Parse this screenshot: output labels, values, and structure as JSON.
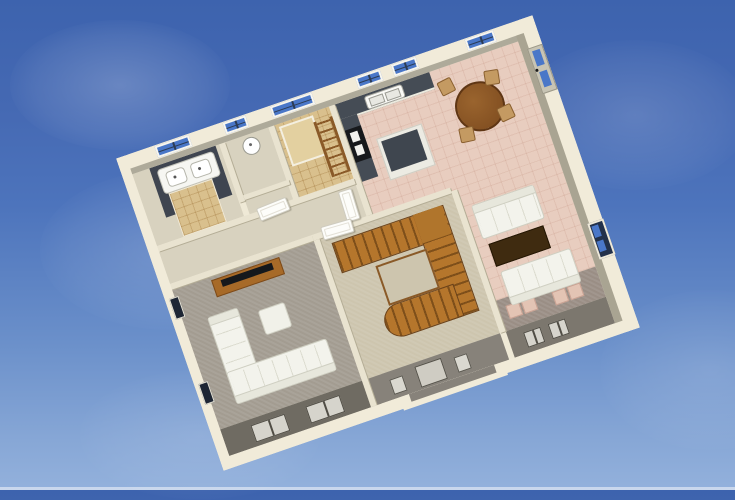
{
  "scene": {
    "label": "Aerial 3D dollhouse rendering of a single-storey floor plan floating against a blue sky",
    "view": "top-down oblique, plan rotated about -19 degrees",
    "sky": {
      "top": "#3d63ae",
      "middle": "#4d74bc",
      "bottom": "#93b1dc",
      "horizon_strip": "#cfdbee",
      "clouds": "faint wispy white"
    }
  },
  "palette": {
    "exterior_wall": "#f1ebd9",
    "wall_face_shaded": "#a9a492",
    "interior_wall": "#e9e3d0",
    "accent_dark_wall": "#3f4550",
    "counter_top": "#454c55",
    "taupe_wall_band": "#87827a",
    "dark_taupe_wall_band": "#6f6b62",
    "tile_pink": "#e8cdbf",
    "tile_tan": "#d9c08d",
    "carpet_gray": "#a39c91",
    "carpet_khaki": "#cdc5ae",
    "carpet_mauve": "#9a8e85",
    "stair_wood": "#b0752c",
    "table_wood": "#8a5426",
    "coffee_table_wood": "#3f2b10",
    "window_glass": "#4a77c8",
    "sofa_white": "#f3f3ec"
  },
  "rooms": [
    {
      "id": "master-bathroom",
      "label": "Bathroom with double-sink vanity, dark accent wall and tan tile"
    },
    {
      "id": "powder-room",
      "label": "Powder room with round basin"
    },
    {
      "id": "shower-bathroom",
      "label": "Bathroom with tan tiled shower and towel ladder"
    },
    {
      "id": "kitchen-dining",
      "label": "Open kitchen and dining area with pink tile floor"
    },
    {
      "id": "hallway",
      "label": "Hallway with white interior doors"
    },
    {
      "id": "family-room",
      "label": "Family room with gray carpet, sectional sofa and TV console"
    },
    {
      "id": "stair-hall",
      "label": "Stair hall with U-shaped wooden staircase"
    },
    {
      "id": "living-room",
      "label": "Living room with two white sofas and coffee table"
    },
    {
      "id": "entry",
      "label": "Front entry with door and sidelights"
    }
  ],
  "furniture": [
    {
      "id": "double-vanity",
      "label": "White double-sink vanity"
    },
    {
      "id": "powder-sink",
      "label": "Round white basin"
    },
    {
      "id": "shower",
      "label": "Tan tiled shower pan"
    },
    {
      "id": "towel-ladder",
      "label": "Wooden towel ladder"
    },
    {
      "id": "kitchen-counter",
      "label": "Dark countertop with white double sink"
    },
    {
      "id": "range",
      "label": "Black range cooker with white ovens"
    },
    {
      "id": "kitchen-island",
      "label": "Kitchen island with dark top"
    },
    {
      "id": "dining-set",
      "label": "Round wooden dining table with four chairs"
    },
    {
      "id": "tv-console",
      "label": "Wooden media console with flat-screen TV"
    },
    {
      "id": "sectional-sofa",
      "label": "L-shaped white sectional sofa"
    },
    {
      "id": "ottoman",
      "label": "White square ottoman"
    },
    {
      "id": "staircase",
      "label": "U-shaped oak staircase with railing"
    },
    {
      "id": "sofa-upper",
      "label": "White sofa facing the coffee table"
    },
    {
      "id": "coffee-table",
      "label": "Dark brown coffee table"
    },
    {
      "id": "sofa-lower",
      "label": "White sofa on mauve carpet"
    },
    {
      "id": "floor-cushions",
      "label": "Pink floor cushions"
    },
    {
      "id": "front-door",
      "label": "Front door with sidelights"
    },
    {
      "id": "patio-door",
      "label": "Glass door with blue panes"
    }
  ]
}
